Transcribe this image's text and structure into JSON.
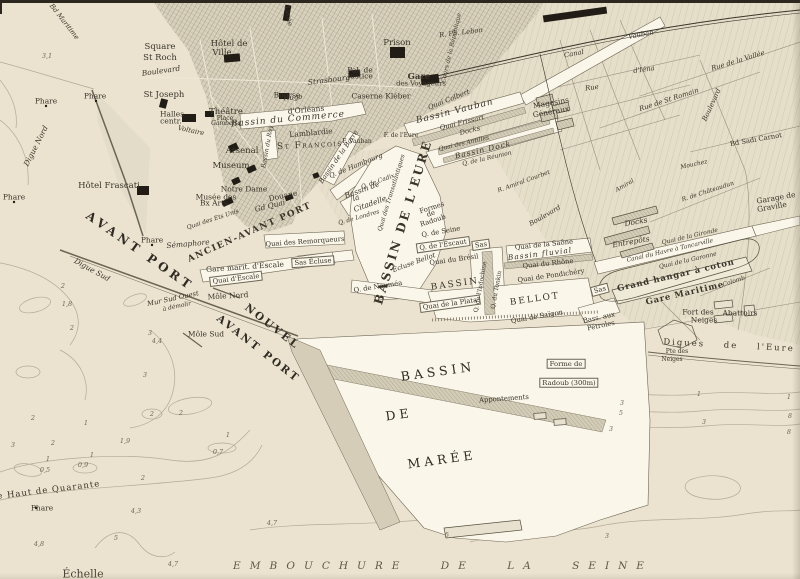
{
  "palette": {
    "paper": "#ebe3d0",
    "water": "#faf6ea",
    "city_fill": "#d8d1bc",
    "suburb_fill": "#e4ddc8",
    "pier_fill": "#d3ccb7",
    "ink": "#33302a",
    "faded_ink": "#6f6857",
    "black": "#211d16",
    "contour": "#b3aa92"
  },
  "labels": [
    {
      "t": "3,1",
      "x": 47,
      "y": 56,
      "k": "depth"
    },
    {
      "t": "Phare",
      "x": 46,
      "y": 101,
      "k": "small"
    },
    {
      "t": "Phare",
      "x": 95,
      "y": 96,
      "k": "small"
    },
    {
      "t": "Phare",
      "x": 14,
      "y": 197,
      "k": "small"
    },
    {
      "t": "Digue Nord",
      "x": 36,
      "y": 146,
      "r": -63,
      "k": "small",
      "i": 1
    },
    {
      "t": "Digue Sud",
      "x": 92,
      "y": 270,
      "r": 29,
      "k": "small",
      "i": 1
    },
    {
      "t": "le Haut de Quarante",
      "x": 47,
      "y": 491,
      "r": -7,
      "k": "med",
      "sp": 1
    },
    {
      "t": "Phare",
      "x": 42,
      "y": 508,
      "k": "small"
    },
    {
      "t": "Échelle",
      "x": 83,
      "y": 574,
      "k": "med2"
    },
    {
      "t": "EMBOUCHURE DE LA SEINE",
      "x": 443,
      "y": 566,
      "k": "seine"
    },
    {
      "t": "2",
      "x": 63,
      "y": 286,
      "k": "depth"
    },
    {
      "t": "1,8",
      "x": 67,
      "y": 304,
      "k": "depth"
    },
    {
      "t": "2",
      "x": 72,
      "y": 328,
      "k": "depth"
    },
    {
      "t": "3",
      "x": 150,
      "y": 333,
      "k": "depth"
    },
    {
      "t": "4,4",
      "x": 157,
      "y": 341,
      "k": "depth"
    },
    {
      "t": "3",
      "x": 145,
      "y": 375,
      "k": "depth"
    },
    {
      "t": "2",
      "x": 33,
      "y": 418,
      "k": "depth"
    },
    {
      "t": "1",
      "x": 86,
      "y": 423,
      "k": "depth"
    },
    {
      "t": "2",
      "x": 53,
      "y": 443,
      "k": "depth"
    },
    {
      "t": "2",
      "x": 152,
      "y": 414,
      "k": "depth"
    },
    {
      "t": "2",
      "x": 181,
      "y": 413,
      "k": "depth"
    },
    {
      "t": "1,9",
      "x": 125,
      "y": 441,
      "k": "depth"
    },
    {
      "t": "3",
      "x": 13,
      "y": 445,
      "k": "depth"
    },
    {
      "t": "1",
      "x": 48,
      "y": 459,
      "k": "depth"
    },
    {
      "t": "0,5",
      "x": 45,
      "y": 470,
      "k": "depth"
    },
    {
      "t": "1",
      "x": 92,
      "y": 455,
      "k": "depth"
    },
    {
      "t": "0,9",
      "x": 83,
      "y": 465,
      "k": "depth"
    },
    {
      "t": "1",
      "x": 228,
      "y": 435,
      "k": "depth"
    },
    {
      "t": "0,7",
      "x": 218,
      "y": 452,
      "k": "depth"
    },
    {
      "t": "2",
      "x": 143,
      "y": 478,
      "k": "depth"
    },
    {
      "t": "4,3",
      "x": 136,
      "y": 511,
      "k": "depth"
    },
    {
      "t": "4,8",
      "x": 39,
      "y": 544,
      "k": "depth"
    },
    {
      "t": "5",
      "x": 116,
      "y": 538,
      "k": "depth"
    },
    {
      "t": "4,7",
      "x": 173,
      "y": 564,
      "k": "depth"
    },
    {
      "t": "4,7",
      "x": 272,
      "y": 523,
      "k": "depth"
    },
    {
      "t": "1",
      "x": 699,
      "y": 394,
      "k": "depth"
    },
    {
      "t": "3",
      "x": 622,
      "y": 403,
      "k": "depth"
    },
    {
      "t": "1",
      "x": 789,
      "y": 397,
      "k": "depth"
    },
    {
      "t": "3",
      "x": 704,
      "y": 422,
      "k": "depth"
    },
    {
      "t": "5",
      "x": 621,
      "y": 413,
      "k": "depth"
    },
    {
      "t": "8",
      "x": 790,
      "y": 416,
      "k": "depth"
    },
    {
      "t": "3",
      "x": 611,
      "y": 429,
      "k": "depth"
    },
    {
      "t": "8",
      "x": 789,
      "y": 432,
      "k": "depth"
    },
    {
      "t": "3",
      "x": 607,
      "y": 536,
      "k": "depth"
    },
    {
      "t": "5",
      "x": 447,
      "y": 535,
      "k": "depth"
    },
    {
      "t": "Bd Maritime",
      "x": 64,
      "y": 22,
      "r": 52,
      "k": "tiny",
      "i": 1
    },
    {
      "t": "Square",
      "x": 160,
      "y": 47,
      "k": "med"
    },
    {
      "t": "St Roch",
      "x": 160,
      "y": 58,
      "k": "med"
    },
    {
      "t": "Hôtel de",
      "x": 229,
      "y": 44,
      "k": "med"
    },
    {
      "t": "Ville",
      "x": 222,
      "y": 53,
      "k": "med"
    },
    {
      "t": "Boulevard",
      "x": 161,
      "y": 71,
      "r": -8,
      "k": "small",
      "i": 1
    },
    {
      "t": "St Joseph",
      "x": 164,
      "y": 95,
      "k": "med"
    },
    {
      "t": "Halles",
      "x": 172,
      "y": 114,
      "k": "small"
    },
    {
      "t": "centr.",
      "x": 171,
      "y": 121,
      "k": "small"
    },
    {
      "t": "Théâtre",
      "x": 226,
      "y": 112,
      "k": "med"
    },
    {
      "t": "Place",
      "x": 225,
      "y": 119,
      "k": "micro"
    },
    {
      "t": "Gambetta",
      "x": 226,
      "y": 124,
      "k": "micro",
      "i": 1
    },
    {
      "t": "Voltaire",
      "x": 191,
      "y": 131,
      "r": 12,
      "k": "tiny",
      "i": 1
    },
    {
      "t": "Arsenal",
      "x": 242,
      "y": 151,
      "k": "med"
    },
    {
      "t": "Museum",
      "x": 231,
      "y": 166,
      "k": "med"
    },
    {
      "t": "Notre Dame",
      "x": 244,
      "y": 189,
      "k": "small"
    },
    {
      "t": "Musée des",
      "x": 216,
      "y": 197,
      "k": "small"
    },
    {
      "t": "Bx Arts",
      "x": 214,
      "y": 203,
      "k": "small"
    },
    {
      "t": "Hôtel Frascati",
      "x": 109,
      "y": 186,
      "k": "med"
    },
    {
      "t": "Sémaphore",
      "x": 188,
      "y": 244,
      "r": -5,
      "k": "small",
      "i": 1
    },
    {
      "t": "Phare",
      "x": 152,
      "y": 240,
      "k": "small"
    },
    {
      "t": "Douane",
      "x": 283,
      "y": 196,
      "r": -12,
      "k": "small"
    },
    {
      "t": "Gd Quai",
      "x": 270,
      "y": 206,
      "r": -14,
      "k": "small",
      "i": 1
    },
    {
      "t": "Quai des Ets Unis",
      "x": 213,
      "y": 220,
      "r": -18,
      "k": "micro",
      "i": 1
    },
    {
      "t": "Bourse",
      "x": 287,
      "y": 95,
      "k": "small"
    },
    {
      "t": "Strasbourg",
      "x": 329,
      "y": 80,
      "r": -7,
      "k": "small",
      "i": 1
    },
    {
      "t": "Pal. de",
      "x": 360,
      "y": 70,
      "k": "small"
    },
    {
      "t": "Justice",
      "x": 360,
      "y": 76,
      "k": "small"
    },
    {
      "t": "Prison",
      "x": 397,
      "y": 43,
      "k": "med"
    },
    {
      "t": "Lycée",
      "x": 288,
      "y": 16,
      "r": 80,
      "k": "tiny"
    },
    {
      "t": "Caserne Kléber",
      "x": 381,
      "y": 96,
      "k": "small"
    },
    {
      "t": "Gare",
      "x": 419,
      "y": 77,
      "k": "med",
      "b": 1
    },
    {
      "t": "des Voyageurs",
      "x": 421,
      "y": 84,
      "k": "tiny"
    },
    {
      "t": "R. Ph. Lebon",
      "x": 461,
      "y": 33,
      "r": -7,
      "k": "tiny",
      "i": 1
    },
    {
      "t": "Cours de la République",
      "x": 452,
      "y": 48,
      "r": -77,
      "k": "micro",
      "i": 1
    },
    {
      "t": "d'Orléans",
      "x": 306,
      "y": 110,
      "r": -5,
      "k": "small"
    },
    {
      "t": "Hugo",
      "x": 293,
      "y": 98,
      "r": -5,
      "k": "tiny",
      "i": 1
    },
    {
      "t": "Bassin du Commerce",
      "x": 288,
      "y": 120,
      "r": -5,
      "k": "basinmed"
    },
    {
      "t": "Lamblardie",
      "x": 311,
      "y": 133,
      "r": -5,
      "k": "small"
    },
    {
      "t": "St François",
      "x": 310,
      "y": 146,
      "r": -3,
      "k": "cap"
    },
    {
      "t": "Bassin du Roy",
      "x": 268,
      "y": 147,
      "r": -80,
      "k": "micro",
      "i": 1
    },
    {
      "t": "Bassin de la Barre",
      "x": 339,
      "y": 157,
      "r": -55,
      "k": "tiny",
      "i": 1
    },
    {
      "t": "F. Vauban",
      "x": 357,
      "y": 142,
      "k": "micro"
    },
    {
      "t": "F. de l'Eure",
      "x": 401,
      "y": 136,
      "k": "micro"
    },
    {
      "t": "Q. de Hambourg",
      "x": 356,
      "y": 166,
      "r": -22,
      "k": "tiny",
      "i": 1
    },
    {
      "t": "Bassin de",
      "x": 362,
      "y": 190,
      "r": -20,
      "k": "small",
      "i": 1
    },
    {
      "t": "la",
      "x": 356,
      "y": 198,
      "r": -20,
      "k": "small",
      "i": 1
    },
    {
      "t": "Citadelle",
      "x": 370,
      "y": 204,
      "r": -20,
      "k": "small",
      "i": 1
    },
    {
      "t": "Q. de Cadix",
      "x": 378,
      "y": 182,
      "r": -20,
      "k": "micro",
      "i": 1
    },
    {
      "t": "Q. de Londres",
      "x": 359,
      "y": 218,
      "r": -16,
      "k": "micro",
      "i": 1
    },
    {
      "t": "Quai des Transatlantiques",
      "x": 392,
      "y": 193,
      "r": -73,
      "k": "micro",
      "i": 1
    },
    {
      "t": "BASSIN DE L'EURE",
      "x": 403,
      "y": 222,
      "r": -73,
      "k": "basinbig"
    },
    {
      "t": "ANCIEN-AVANT PORT",
      "x": 250,
      "y": 233,
      "r": -24,
      "k": "capsp"
    },
    {
      "t": "AVANT PORT",
      "x": 140,
      "y": 251,
      "r": 35,
      "k": "bigsp"
    },
    {
      "t": "NOUVEL",
      "x": 272,
      "y": 327,
      "r": 38,
      "k": "bigsp2"
    },
    {
      "t": "AVANT PORT",
      "x": 258,
      "y": 349,
      "r": 38,
      "k": "bigsp2"
    },
    {
      "t": "Quai des Remorqueurs",
      "x": 305,
      "y": 242,
      "r": -4,
      "k": "tiny"
    },
    {
      "t": "Sas Écluse",
      "x": 313,
      "y": 262,
      "r": -4,
      "k": "boxed"
    },
    {
      "t": "Gare marit. d'Escale",
      "x": 245,
      "y": 267,
      "r": -4,
      "k": "small"
    },
    {
      "t": "Quai d'Escale",
      "x": 236,
      "y": 279,
      "r": -7,
      "k": "boxed"
    },
    {
      "t": "Mur Sud Ouest",
      "x": 173,
      "y": 299,
      "r": -12,
      "k": "tiny",
      "i": 1
    },
    {
      "t": "à démolir",
      "x": 177,
      "y": 307,
      "r": -12,
      "k": "micro",
      "i": 1
    },
    {
      "t": "Môle Nord",
      "x": 228,
      "y": 296,
      "r": -3,
      "k": "small"
    },
    {
      "t": "Môle Sud",
      "x": 206,
      "y": 334,
      "k": "small"
    },
    {
      "t": "Q. de Nouméa",
      "x": 378,
      "y": 287,
      "r": -9,
      "k": "tiny"
    },
    {
      "t": "Écluse Bellot",
      "x": 414,
      "y": 263,
      "r": -20,
      "k": "tiny",
      "i": 1
    },
    {
      "t": "Formes",
      "x": 432,
      "y": 208,
      "r": -18,
      "k": "tiny"
    },
    {
      "t": "de",
      "x": 431,
      "y": 214,
      "r": -18,
      "k": "tiny"
    },
    {
      "t": "Radoub",
      "x": 433,
      "y": 221,
      "r": -18,
      "k": "tiny"
    },
    {
      "t": "Q. de Seine",
      "x": 441,
      "y": 232,
      "r": -10,
      "k": "tiny"
    },
    {
      "t": "Q. de l'Escaut",
      "x": 443,
      "y": 245,
      "r": -8,
      "k": "boxed"
    },
    {
      "t": "Quai du Brésil",
      "x": 454,
      "y": 260,
      "r": -8,
      "k": "tiny"
    },
    {
      "t": "Sas",
      "x": 481,
      "y": 245,
      "r": -8,
      "k": "boxed"
    },
    {
      "t": "BASSIN",
      "x": 455,
      "y": 285,
      "r": -8,
      "k": "basincap"
    },
    {
      "t": "BELLOT",
      "x": 535,
      "y": 300,
      "r": -8,
      "k": "basincap"
    },
    {
      "t": "Quai de la Plata",
      "x": 450,
      "y": 304,
      "r": -8,
      "k": "boxed"
    },
    {
      "t": "Quai de Saïgon",
      "x": 537,
      "y": 317,
      "r": -10,
      "k": "tiny"
    },
    {
      "t": "Q. de l'Indochine",
      "x": 481,
      "y": 287,
      "r": -80,
      "k": "micro"
    },
    {
      "t": "Q. du Tonkin",
      "x": 497,
      "y": 290,
      "r": -80,
      "k": "micro"
    },
    {
      "t": "Quai de la Saône",
      "x": 544,
      "y": 245,
      "r": -6,
      "k": "tiny"
    },
    {
      "t": "Bassin fluvial",
      "x": 540,
      "y": 254,
      "r": -7,
      "k": "small",
      "i": 1,
      "sp": 1
    },
    {
      "t": "Quai du Rhône",
      "x": 548,
      "y": 264,
      "r": -6,
      "k": "tiny"
    },
    {
      "t": "Quai de Pondichéry",
      "x": 551,
      "y": 276,
      "r": -8,
      "k": "tiny"
    },
    {
      "t": "Sas",
      "x": 600,
      "y": 290,
      "r": -15,
      "k": "boxed"
    },
    {
      "t": "Bass. aux",
      "x": 599,
      "y": 318,
      "r": -12,
      "k": "tiny"
    },
    {
      "t": "Pétroles",
      "x": 601,
      "y": 326,
      "r": -12,
      "k": "tiny"
    },
    {
      "t": "Grand hangar à coton",
      "x": 676,
      "y": 276,
      "r": -13,
      "k": "medsp"
    },
    {
      "t": "Gare Maritime",
      "x": 685,
      "y": 294,
      "r": -13,
      "k": "medsp"
    },
    {
      "t": "Quai de la Gironde",
      "x": 690,
      "y": 237,
      "r": -13,
      "k": "micro",
      "i": 1
    },
    {
      "t": "Canal du Havre à Tancarville",
      "x": 670,
      "y": 251,
      "r": -13,
      "k": "micro",
      "i": 1
    },
    {
      "t": "Quai de la Garonne",
      "x": 688,
      "y": 261,
      "r": -13,
      "k": "micro",
      "i": 1
    },
    {
      "t": "Docks",
      "x": 636,
      "y": 222,
      "r": -10,
      "k": "small",
      "i": 1
    },
    {
      "t": "Entrepôts",
      "x": 631,
      "y": 242,
      "r": -10,
      "k": "small",
      "i": 1
    },
    {
      "t": "Garage de",
      "x": 776,
      "y": 198,
      "r": -10,
      "k": "small"
    },
    {
      "t": "Graville",
      "x": 772,
      "y": 207,
      "r": -10,
      "k": "small"
    },
    {
      "t": "Abattoirs",
      "x": 740,
      "y": 313,
      "k": "small"
    },
    {
      "t": "Fort des",
      "x": 698,
      "y": 312,
      "k": "small"
    },
    {
      "t": "Neiges",
      "x": 704,
      "y": 320,
      "k": "small"
    },
    {
      "t": "Digues de l'Eure",
      "x": 729,
      "y": 346,
      "r": 3,
      "k": "med",
      "sp": 2,
      "ws": 14
    },
    {
      "t": "Pte des",
      "x": 677,
      "y": 352,
      "k": "micro"
    },
    {
      "t": "Neiges",
      "x": 672,
      "y": 360,
      "k": "micro"
    },
    {
      "t": "Forme de",
      "x": 566,
      "y": 364,
      "k": "boxed"
    },
    {
      "t": "Radoub (300m)",
      "x": 569,
      "y": 383,
      "k": "boxed"
    },
    {
      "t": "Appontements",
      "x": 504,
      "y": 399,
      "r": -4,
      "k": "tiny"
    },
    {
      "t": "BASSIN",
      "x": 438,
      "y": 372,
      "r": -8,
      "k": "maree"
    },
    {
      "t": "DE",
      "x": 399,
      "y": 415,
      "r": -8,
      "k": "maree"
    },
    {
      "t": "MARÉE",
      "x": 442,
      "y": 460,
      "r": -8,
      "k": "maree"
    },
    {
      "t": "Canal",
      "x": 574,
      "y": 54,
      "r": -11,
      "k": "tiny",
      "i": 1
    },
    {
      "t": "Vauban",
      "x": 641,
      "y": 35,
      "r": -11,
      "k": "tiny",
      "i": 1
    },
    {
      "t": "Rue",
      "x": 592,
      "y": 88,
      "r": -8,
      "k": "tiny",
      "i": 1
    },
    {
      "t": "d'Iéna",
      "x": 644,
      "y": 70,
      "r": -8,
      "k": "tiny",
      "i": 1
    },
    {
      "t": "Rue de la Vallée",
      "x": 738,
      "y": 61,
      "r": -17,
      "k": "tiny",
      "i": 1
    },
    {
      "t": "Rue de St Romain",
      "x": 669,
      "y": 100,
      "r": -18,
      "k": "tiny",
      "i": 1
    },
    {
      "t": "Boulevard",
      "x": 712,
      "y": 105,
      "r": -65,
      "k": "tiny",
      "i": 1
    },
    {
      "t": "Bd Sadi Carnot",
      "x": 756,
      "y": 140,
      "r": -10,
      "k": "tiny"
    },
    {
      "t": "R. de Châteaudun",
      "x": 708,
      "y": 192,
      "r": -18,
      "k": "micro",
      "i": 1
    },
    {
      "t": "Mouchez",
      "x": 694,
      "y": 165,
      "r": -12,
      "k": "micro",
      "i": 1
    },
    {
      "t": "Amiral",
      "x": 625,
      "y": 186,
      "r": -30,
      "k": "micro",
      "i": 1
    },
    {
      "t": "R. Amiral Courbet",
      "x": 524,
      "y": 182,
      "r": -20,
      "k": "micro",
      "i": 1
    },
    {
      "t": "Boulevard",
      "x": 545,
      "y": 216,
      "r": -30,
      "k": "tiny",
      "i": 1
    },
    {
      "t": "Colomb",
      "x": 734,
      "y": 282,
      "r": -18,
      "k": "micro",
      "i": 1
    },
    {
      "t": "Magasins",
      "x": 551,
      "y": 103,
      "r": -10,
      "k": "small"
    },
    {
      "t": "Généraux",
      "x": 551,
      "y": 112,
      "r": -10,
      "k": "small"
    },
    {
      "t": "Quai Colbert",
      "x": 449,
      "y": 100,
      "r": -22,
      "k": "tiny",
      "i": 1
    },
    {
      "t": "Bassin Vauban",
      "x": 455,
      "y": 112,
      "r": -14,
      "k": "basinmed"
    },
    {
      "t": "Quai Frissart",
      "x": 462,
      "y": 123,
      "r": -14,
      "k": "tiny",
      "i": 1
    },
    {
      "t": "Docks",
      "x": 470,
      "y": 131,
      "r": -14,
      "k": "tiny",
      "i": 1
    },
    {
      "t": "Quai des Antilles",
      "x": 464,
      "y": 144,
      "r": -13,
      "k": "micro",
      "i": 1
    },
    {
      "t": "Bassin Dock",
      "x": 483,
      "y": 150,
      "r": -13,
      "k": "small",
      "i": 1,
      "sp": 1
    },
    {
      "t": "Q. de la Réunion",
      "x": 487,
      "y": 159,
      "r": -13,
      "k": "micro",
      "i": 1
    }
  ],
  "buildings": [
    [
      232,
      58,
      16,
      8,
      -5
    ],
    [
      163,
      103,
      7,
      9,
      15
    ],
    [
      189,
      118,
      14,
      8,
      0
    ],
    [
      209,
      114,
      9,
      6,
      0
    ],
    [
      284,
      96,
      10,
      6,
      0
    ],
    [
      287,
      13,
      6,
      16,
      10
    ],
    [
      397,
      52,
      15,
      11,
      0
    ],
    [
      354,
      73,
      11,
      7,
      -5
    ],
    [
      430,
      79,
      18,
      9,
      -8
    ],
    [
      233,
      147,
      9,
      7,
      -25
    ],
    [
      251,
      169,
      9,
      6,
      -25
    ],
    [
      236,
      181,
      8,
      6,
      -25
    ],
    [
      227,
      202,
      11,
      6,
      -25
    ],
    [
      143,
      190,
      12,
      9,
      0
    ],
    [
      289,
      197,
      8,
      5,
      -20
    ],
    [
      316,
      175,
      6,
      5,
      -20
    ],
    [
      575,
      14,
      64,
      7,
      -8
    ]
  ]
}
